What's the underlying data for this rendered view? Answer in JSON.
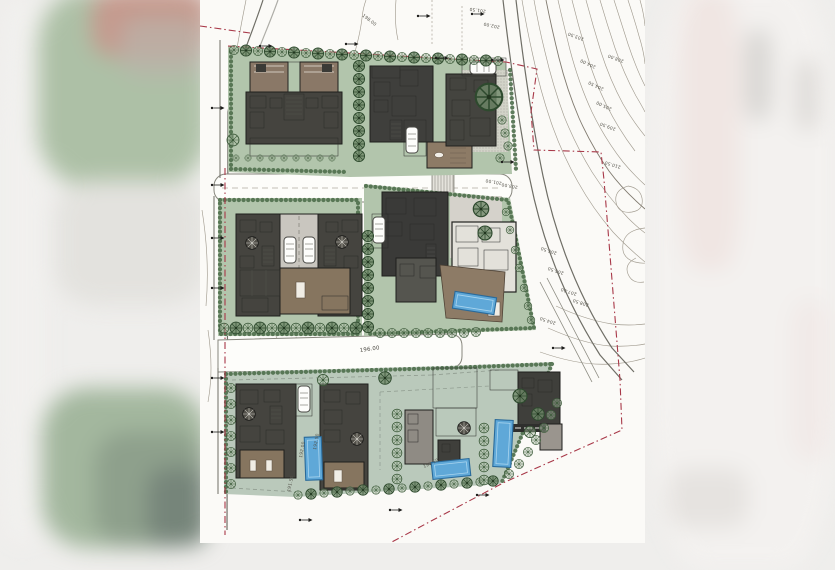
{
  "image": {
    "alt": "Scanned architectural site master plan: three rows of villa lots with lawns, hedges, trees, cars and four swimming pools; red dash-dot parcel boundary; topographic contour lines with spot elevations on the east side; blurred photo margins left and right"
  },
  "colors": {
    "paper": "#fbfaf7",
    "lawn": "#b2c5ac",
    "lawn_cool": "#bac9bb",
    "hedge_green": "#4e6e4b",
    "tree_green": "#3c5a3a",
    "roof_brown": "#8a7867",
    "deck_brown": "#8d7b66",
    "building_dark": "#45443f",
    "pool_blue": "#5fa8d8",
    "boundary_red": "#a83848",
    "contour_gray": "#a29c90"
  },
  "site": {
    "boundary_style": "red dash-dot parcel line",
    "building_lots_count": 10,
    "swimming_pools_count": 4,
    "pool_color": "#5fa8d8"
  },
  "labels": {
    "road": [
      {
        "text": "198.00",
        "x": 162,
        "y": 16,
        "rot": 38
      },
      {
        "text": "196.00",
        "x": 160,
        "y": 352,
        "rot": -8
      },
      {
        "text": "191.50",
        "x": 90,
        "y": 492,
        "rot": -78
      },
      {
        "text": "192.00",
        "x": 102,
        "y": 458,
        "rot": -80
      },
      {
        "text": "192.50",
        "x": 116,
        "y": 450,
        "rot": -80
      },
      {
        "text": "190.50",
        "x": 224,
        "y": 468,
        "rot": -25
      }
    ],
    "contour": [
      {
        "text": "201.50",
        "x": 286,
        "y": 10,
        "rot": 188
      },
      {
        "text": "202.00",
        "x": 300,
        "y": 26,
        "rot": 192
      },
      {
        "text": "203.50",
        "x": 384,
        "y": 38,
        "rot": 200
      },
      {
        "text": "204.00",
        "x": 396,
        "y": 66,
        "rot": 205
      },
      {
        "text": "204.50",
        "x": 404,
        "y": 88,
        "rot": 205
      },
      {
        "text": "205.00",
        "x": 412,
        "y": 108,
        "rot": 205
      },
      {
        "text": "208.00",
        "x": 424,
        "y": 60,
        "rot": 200
      },
      {
        "text": "209.50",
        "x": 416,
        "y": 128,
        "rot": 200
      },
      {
        "text": "210.50",
        "x": 421,
        "y": 166,
        "rot": 197
      },
      {
        "text": "206.50",
        "x": 357,
        "y": 252,
        "rot": 198
      },
      {
        "text": "205.50",
        "x": 364,
        "y": 272,
        "rot": 198
      },
      {
        "text": "207.00",
        "x": 377,
        "y": 293,
        "rot": 198
      },
      {
        "text": "208.50",
        "x": 389,
        "y": 304,
        "rot": 198
      },
      {
        "text": "204.50",
        "x": 356,
        "y": 322,
        "rot": 198
      },
      {
        "text": "201.00",
        "x": 302,
        "y": 182,
        "rot": 190
      },
      {
        "text": "203.00",
        "x": 318,
        "y": 186,
        "rot": 190
      }
    ]
  }
}
